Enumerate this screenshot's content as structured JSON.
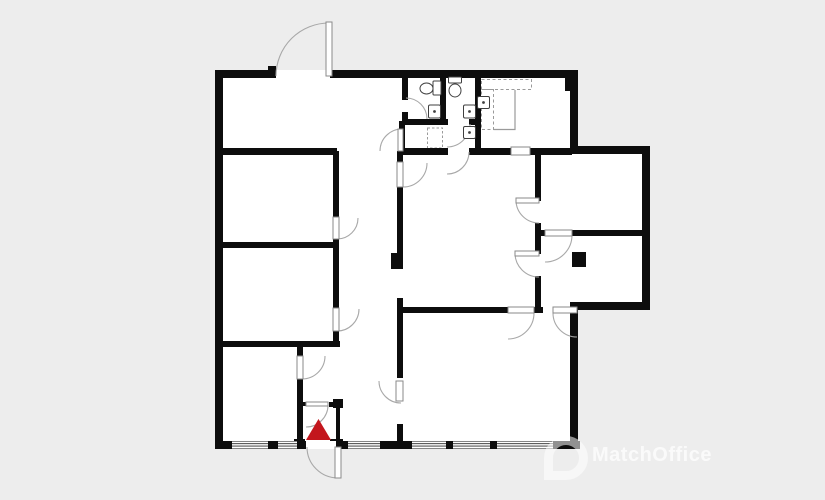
{
  "watermark": {
    "text": "MatchOffice",
    "logo": "map-pin-ring"
  },
  "colors": {
    "background": "#ededed",
    "floor": "#ffffff",
    "wall": "#0d0d0d",
    "door_arc": "#a8a8a8",
    "leaf_stroke": "#8a8a8a",
    "fixture": "#3f3f3f",
    "dashed": "#9a9a9a",
    "counter": "#9a9a9a",
    "glass": "#2a2a2a",
    "entrance": "#c3161d"
  },
  "floorplan": {
    "canvas": [
      825,
      500
    ],
    "floors": [
      [
        215,
        70,
        363,
        378
      ],
      [
        560,
        146,
        90,
        164
      ]
    ],
    "walls": [
      [
        215,
        70,
        61,
        8
      ],
      [
        330,
        70,
        248,
        8
      ],
      [
        215,
        70,
        8,
        378
      ],
      [
        215,
        441,
        365,
        8
      ],
      [
        570,
        70,
        8,
        82
      ],
      [
        570,
        146,
        80,
        8
      ],
      [
        642,
        146,
        8,
        164
      ],
      [
        570,
        302,
        80,
        8
      ],
      [
        570,
        302,
        8,
        146
      ],
      [
        268,
        66,
        8,
        11
      ],
      [
        565,
        78,
        13,
        13
      ],
      [
        572,
        252,
        14,
        15
      ],
      [
        391,
        253,
        12,
        16
      ],
      [
        217,
        148,
        120,
        7
      ],
      [
        403,
        148,
        45,
        7
      ],
      [
        469,
        148,
        42,
        7
      ],
      [
        530,
        148,
        42,
        7
      ],
      [
        217,
        242,
        121,
        6
      ],
      [
        217,
        341,
        123,
        6
      ],
      [
        333,
        151,
        6,
        66
      ],
      [
        333,
        239,
        6,
        70
      ],
      [
        333,
        331,
        6,
        14
      ],
      [
        297,
        341,
        6,
        15
      ],
      [
        297,
        379,
        6,
        69
      ],
      [
        397,
        151,
        6,
        12
      ],
      [
        397,
        187,
        6,
        66
      ],
      [
        397,
        298,
        6,
        80
      ],
      [
        397,
        424,
        6,
        24
      ],
      [
        399,
        121,
        6,
        30
      ],
      [
        402,
        78,
        6,
        22
      ],
      [
        402,
        112,
        6,
        9
      ],
      [
        402,
        119,
        46,
        6
      ],
      [
        469,
        119,
        12,
        6
      ],
      [
        440,
        78,
        6,
        47
      ],
      [
        475,
        78,
        6,
        74
      ],
      [
        535,
        151,
        6,
        50
      ],
      [
        535,
        223,
        6,
        31
      ],
      [
        535,
        276,
        6,
        37
      ],
      [
        403,
        307,
        106,
        6
      ],
      [
        533,
        307,
        10,
        6
      ],
      [
        535,
        230,
        11,
        6
      ],
      [
        572,
        230,
        78,
        6
      ],
      [
        303,
        402,
        4,
        4
      ],
      [
        329,
        402,
        13,
        5
      ],
      [
        333,
        399,
        10,
        9
      ],
      [
        336,
        402,
        4,
        46
      ],
      [
        294,
        439,
        11,
        10
      ],
      [
        330,
        439,
        13,
        10
      ]
    ],
    "wall_openings": [
      [
        306,
        441,
        30,
        8
      ]
    ],
    "windows": {
      "y": 441.5,
      "h": 7,
      "glass_offsets": [
        2.2,
        4.6
      ],
      "segments": [
        [
          232,
          36
        ],
        [
          278,
          19
        ],
        [
          348,
          32
        ],
        [
          412,
          34
        ],
        [
          453,
          37
        ],
        [
          497,
          56
        ]
      ]
    },
    "doors": [
      {
        "start": "276 76",
        "r": 53,
        "sweep": 1,
        "end": "329 23"
      },
      {
        "start": "406 98",
        "r": 21,
        "sweep": 1,
        "end": "427 119"
      },
      {
        "start": "470 124",
        "r": 23,
        "sweep": 1,
        "end": "447 147"
      },
      {
        "start": "469 152",
        "r": 22,
        "sweep": 1,
        "end": "447 174"
      },
      {
        "start": "380 151",
        "r": 22,
        "sweep": 1,
        "end": "402 129"
      },
      {
        "start": "358 218",
        "r": 21,
        "sweep": 1,
        "end": "337 239"
      },
      {
        "start": "359 309",
        "r": 22,
        "sweep": 1,
        "end": "337 331"
      },
      {
        "start": "325 356",
        "r": 23,
        "sweep": 1,
        "end": "302 379"
      },
      {
        "start": "379 381",
        "r": 22,
        "sweep": 0,
        "end": "401 403"
      },
      {
        "start": "427 163",
        "r": 24,
        "sweep": 1,
        "end": "403 187"
      },
      {
        "start": "516 200",
        "r": 23,
        "sweep": 0,
        "end": "539 223"
      },
      {
        "start": "515 253",
        "r": 24,
        "sweep": 0,
        "end": "539 277"
      },
      {
        "start": "534 313",
        "r": 26,
        "sweep": 1,
        "end": "508 339"
      },
      {
        "start": "553 313",
        "r": 24,
        "sweep": 0,
        "end": "577 337"
      },
      {
        "start": "572 235",
        "r": 27,
        "sweep": 1,
        "end": "545 262"
      },
      {
        "start": "328 405",
        "r": 22,
        "sweep": 1,
        "end": "306 427"
      },
      {
        "start": "307 447",
        "r": 31,
        "sweep": 0,
        "end": "338 478"
      }
    ],
    "door_leaves": [
      [
        326,
        22,
        6,
        54
      ],
      [
        398,
        129,
        5,
        22
      ],
      [
        397,
        162,
        6,
        25
      ],
      [
        333,
        217,
        6,
        22
      ],
      [
        333,
        308,
        6,
        23
      ],
      [
        297,
        356,
        6,
        23
      ],
      [
        396,
        381,
        7,
        20
      ],
      [
        516,
        198,
        23,
        5
      ],
      [
        515,
        251,
        24,
        5
      ],
      [
        508,
        307,
        26,
        6
      ],
      [
        553,
        307,
        24,
        6
      ],
      [
        545,
        230,
        27,
        6
      ],
      [
        511,
        147,
        19,
        8
      ],
      [
        335,
        447,
        6,
        31
      ],
      [
        306,
        402,
        22,
        4
      ]
    ],
    "toilets": [
      {
        "tank": [
          433,
          81,
          8,
          14
        ],
        "bowl": [
          426.5,
          88.5,
          6.5,
          5.5
        ]
      },
      {
        "tank": [
          448.5,
          77,
          13,
          6
        ],
        "bowl": [
          455,
          90.5,
          6,
          6.5
        ]
      }
    ],
    "sinks": [
      [
        428.5,
        105,
        12,
        13
      ],
      [
        463.5,
        105,
        12,
        13
      ],
      [
        463.5,
        126.5,
        12,
        12
      ],
      [
        477.5,
        96.5,
        12,
        12
      ]
    ],
    "shower": [
      427.5,
      128,
      15,
      20
    ],
    "counters": {
      "dashed_rects": [
        [
          481.5,
          79.5,
          50,
          10
        ],
        [
          481.5,
          89.5,
          12,
          40
        ]
      ],
      "edge_path": "M 493.5 129.5 L 515 129.5 L 515 90"
    },
    "entrance_marker": {
      "points": "306,440 331,440 318.5,419"
    }
  }
}
